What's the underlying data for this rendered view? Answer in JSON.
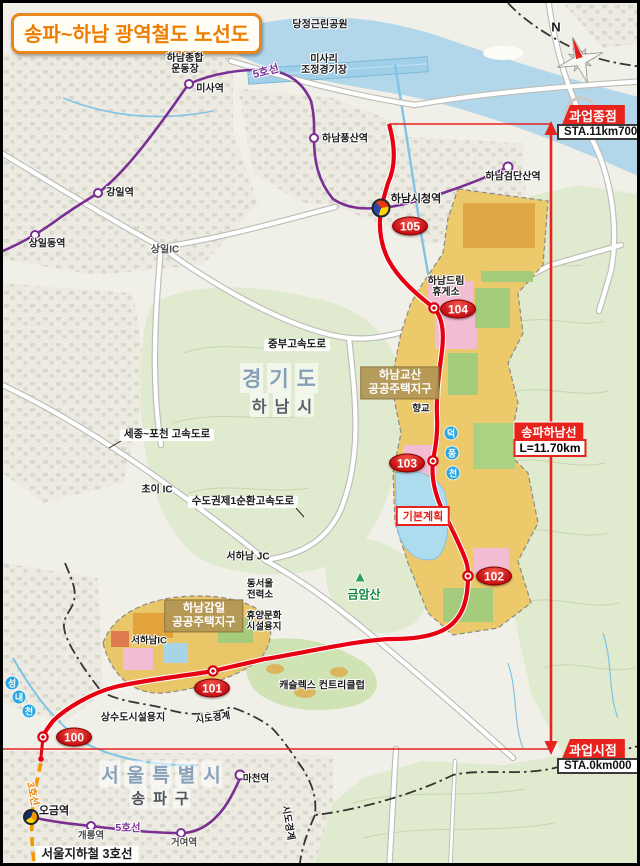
{
  "title": "송파~하남 광역철도 노선도",
  "compass_n": "N",
  "terminus_end": {
    "label": "과업종점",
    "sta": "STA.11km700"
  },
  "terminus_start": {
    "label": "과업시점",
    "sta": "STA.0km000"
  },
  "line_info": {
    "name": "송파하남선",
    "length": "L=11.70km"
  },
  "plan_label": "기본계획",
  "colors": {
    "route_red": "#e60012",
    "metro5_purple": "#7a2f93",
    "metro3_orange": "#f39800",
    "district_tan": "#b29654"
  },
  "stations": [
    {
      "id": "100"
    },
    {
      "id": "101"
    },
    {
      "id": "102"
    },
    {
      "id": "103"
    },
    {
      "id": "104"
    },
    {
      "id": "105"
    }
  ],
  "metro": {
    "line5_label_top": "5호선",
    "line5_label_bottom": "5호선",
    "line3_label": "3호선",
    "line3_name": "서울지하철 3호선",
    "misa": "미사역",
    "gangil": "강일역",
    "sangildong": "상일동역",
    "pungsan": "하남풍산역",
    "geomdansan": "하남검단산역",
    "cityhall": "하남시청역",
    "macheon": "마천역",
    "ogeum": "오금역",
    "gaerong": "개롱역",
    "geoyeo": "거여역"
  },
  "regions": {
    "gyeonggi": [
      "경",
      "기",
      "도"
    ],
    "hanam": [
      "하",
      "남",
      "시"
    ],
    "seoul": [
      "서",
      "울",
      "특",
      "별",
      "시"
    ],
    "songpa": [
      "송",
      "파",
      "구"
    ]
  },
  "districts": {
    "gyosan": {
      "line1": "하남교산",
      "line2": "공공주택지구"
    },
    "gamil": {
      "line1": "하남감일",
      "line2": "공공주택지구"
    }
  },
  "roads": {
    "jungbu": "중부고속도로",
    "sejong_pocheon": "세종~포천 고속도로",
    "sunhwan": "수도권제1순환고속도로",
    "choi_ic": "초이 IC",
    "seohanam_jc": "서하남 JC",
    "seohanam_ic": "서하남IC",
    "sangil_ic": "상일IC"
  },
  "places": {
    "dangjeong": "당정근린공원",
    "sports1": "하남종합",
    "sports2": "운동장",
    "misari1": "미사리",
    "misari2": "조정경기장",
    "dream1": "하남드림",
    "dream2": "휴게소",
    "hyanggyo": "향교",
    "power1": "동서울",
    "power2": "전력소",
    "resort1": "휴양문화",
    "resort2": "시설용지",
    "castlex": "캐슬렉스 컨트리클럽",
    "waterworks": "상수도시설용지",
    "geumamsan": "금암산",
    "mountain_icon": "▲"
  },
  "rivers": {
    "deokpung": [
      "덕",
      "풍",
      "천"
    ],
    "seongnae": [
      "성",
      "내",
      "천"
    ]
  },
  "boundary_label": "시도경계"
}
